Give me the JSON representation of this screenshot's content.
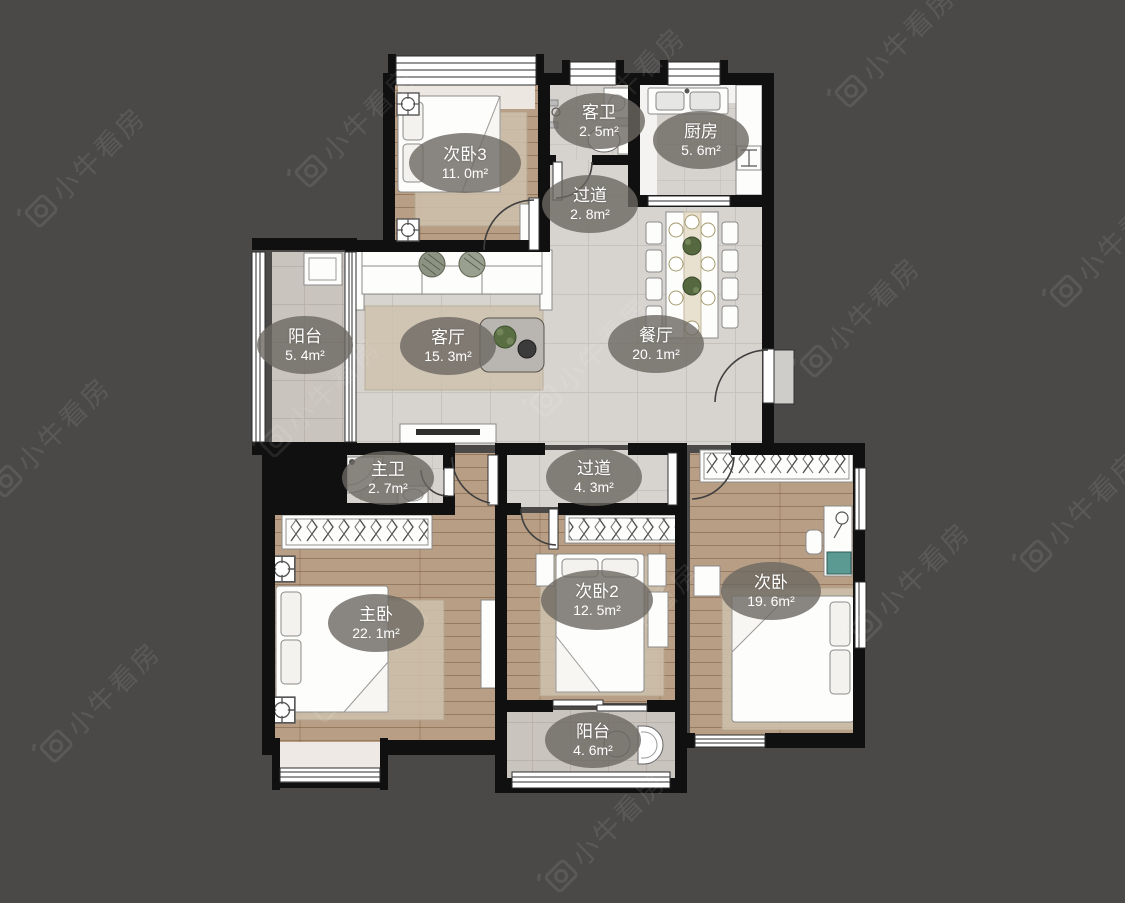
{
  "watermark": {
    "text": "小牛看房"
  },
  "plan": {
    "rooms": [
      {
        "id": "bedroom3",
        "name": "次卧3",
        "area": "11. 0m²"
      },
      {
        "id": "guest-bathroom",
        "name": "客卫",
        "area": "2. 5m²"
      },
      {
        "id": "kitchen",
        "name": "厨房",
        "area": "5. 6m²"
      },
      {
        "id": "hallway-upper",
        "name": "过道",
        "area": "2. 8m²"
      },
      {
        "id": "balcony-left",
        "name": "阳台",
        "area": "5. 4m²"
      },
      {
        "id": "living-room",
        "name": "客厅",
        "area": "15. 3m²"
      },
      {
        "id": "dining-room",
        "name": "餐厅",
        "area": "20. 1m²"
      },
      {
        "id": "master-bathroom",
        "name": "主卫",
        "area": "2. 7m²"
      },
      {
        "id": "hallway-lower",
        "name": "过道",
        "area": "4. 3m²"
      },
      {
        "id": "master-bedroom",
        "name": "主卧",
        "area": "22. 1m²"
      },
      {
        "id": "bedroom2",
        "name": "次卧2",
        "area": "12. 5m²"
      },
      {
        "id": "bedroom",
        "name": "次卧",
        "area": "19. 6m²"
      },
      {
        "id": "balcony-bottom",
        "name": "阳台",
        "area": "4. 6m²"
      }
    ]
  },
  "colors": {
    "background": "#4a4948",
    "wall": "#101010",
    "tile_floor": "#d7d4d0",
    "balcony_floor": "#c9c4bd",
    "bath_floor": "#d6d2cd",
    "wood_floor": "#b89e84",
    "label_background": "rgba(108,104,98,0.80)",
    "label_text": "#ffffff"
  }
}
